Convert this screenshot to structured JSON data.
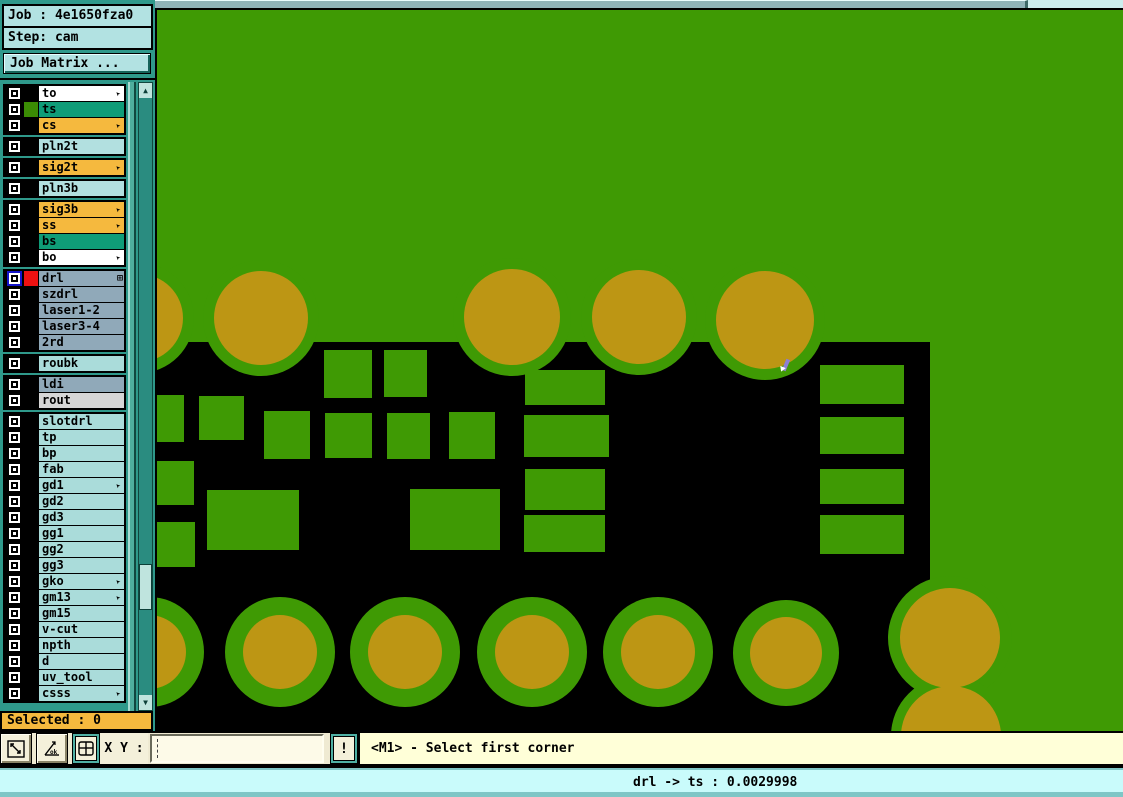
{
  "app": {
    "bg": "#2f998b"
  },
  "job_panel": {
    "job": "Job : 4e1650fza0",
    "step": "Step: cam",
    "matrix_button": "Job Matrix ..."
  },
  "icons": {
    "layer_arrow": "➤",
    "layer_grid": "⊞",
    "scroll_up": "▲",
    "scroll_down": "▼",
    "alert": "!"
  },
  "layers": {
    "groups": [
      {
        "rows": [
          {
            "label": "to",
            "bg": "#ffffff",
            "arrow": true
          },
          {
            "label": "ts",
            "bg": "#0f9c78",
            "swatch": "#3b8c04"
          },
          {
            "label": "cs",
            "bg": "#f5b93e",
            "arrow": true
          }
        ]
      },
      {
        "rows": [
          {
            "label": "pln2t",
            "bg": "#b2e0e0"
          }
        ]
      },
      {
        "rows": [
          {
            "label": "sig2t",
            "bg": "#f5b93e",
            "arrow": true
          }
        ]
      },
      {
        "rows": [
          {
            "label": "pln3b",
            "bg": "#b2e0e0"
          }
        ]
      },
      {
        "rows": [
          {
            "label": "sig3b",
            "bg": "#f5b93e",
            "arrow": true
          },
          {
            "label": "ss",
            "bg": "#f5b93e",
            "arrow": true
          },
          {
            "label": "bs",
            "bg": "#0f9c78"
          },
          {
            "label": "bo",
            "bg": "#ffffff",
            "arrow": true
          }
        ]
      },
      {
        "rows": [
          {
            "label": "drl",
            "bg": "#90a9b9",
            "swatch": "#ee1111",
            "active": true,
            "grid": true
          },
          {
            "label": "szdrl",
            "bg": "#90a9b9"
          },
          {
            "label": "laser1-2",
            "bg": "#90a9b9"
          },
          {
            "label": "laser3-4",
            "bg": "#90a9b9"
          },
          {
            "label": "2rd",
            "bg": "#90a9b9"
          }
        ]
      },
      {
        "rows": [
          {
            "label": "roubk",
            "bg": "#aadcda"
          }
        ]
      },
      {
        "rows": [
          {
            "label": "ldi",
            "bg": "#90a9b9"
          },
          {
            "label": "rout",
            "bg": "#d6d6d6"
          }
        ]
      },
      {
        "rows": [
          {
            "label": "slotdrl",
            "bg": "#aadcda"
          },
          {
            "label": "tp",
            "bg": "#aadcda"
          },
          {
            "label": "bp",
            "bg": "#aadcda"
          },
          {
            "label": "fab",
            "bg": "#aadcda"
          },
          {
            "label": "gd1",
            "bg": "#aadcda",
            "arrow": true
          },
          {
            "label": "gd2",
            "bg": "#aadcda"
          },
          {
            "label": "gd3",
            "bg": "#aadcda"
          },
          {
            "label": "gg1",
            "bg": "#aadcda"
          },
          {
            "label": "gg2",
            "bg": "#aadcda"
          },
          {
            "label": "gg3",
            "bg": "#aadcda"
          },
          {
            "label": "gko",
            "bg": "#aadcda",
            "arrow": true
          },
          {
            "label": "gm13",
            "bg": "#aadcda",
            "arrow": true
          },
          {
            "label": "gm15",
            "bg": "#aadcda"
          },
          {
            "label": "v-cut",
            "bg": "#aadcda"
          },
          {
            "label": "npth",
            "bg": "#aadcda"
          },
          {
            "label": "d",
            "bg": "#aadcda"
          },
          {
            "label": "uv_tool",
            "bg": "#aadcda"
          },
          {
            "label": "csss",
            "bg": "#aadcda",
            "arrow": true
          }
        ]
      }
    ]
  },
  "selected_bar": {
    "text": "Selected : 0"
  },
  "toolbar": {
    "xy_label": "X Y :",
    "input_value": "",
    "message": "<M1> - Select first corner"
  },
  "status_bar": {
    "text": "drl -> ts : 0.0029998"
  },
  "canvas": {
    "colors": {
      "board_green": "#3f9a04",
      "copper_pad_green": "#3f9a04",
      "drill_olive": "#bd9614",
      "clearance_black": "#000000",
      "cursor_violet": "#8d7fd4"
    },
    "black_region": [
      0,
      332,
      773,
      391
    ],
    "smd_pads": [
      [
        167,
        340,
        48,
        48
      ],
      [
        227,
        340,
        43,
        47
      ],
      [
        0,
        385,
        27,
        47
      ],
      [
        42,
        386,
        45,
        44
      ],
      [
        107,
        401,
        46,
        48
      ],
      [
        168,
        403,
        47,
        45
      ],
      [
        230,
        403,
        43,
        46
      ],
      [
        292,
        402,
        46,
        47
      ],
      [
        0,
        451,
        37,
        44
      ],
      [
        0,
        512,
        38,
        45
      ],
      [
        50,
        480,
        92,
        60
      ],
      [
        253,
        479,
        90,
        61
      ],
      [
        368,
        360,
        80,
        35
      ],
      [
        367,
        405,
        85,
        42
      ],
      [
        368,
        459,
        80,
        41
      ],
      [
        367,
        505,
        81,
        37
      ],
      [
        663,
        355,
        84,
        39
      ],
      [
        663,
        407,
        84,
        37
      ],
      [
        663,
        459,
        84,
        35
      ],
      [
        663,
        505,
        84,
        39
      ]
    ],
    "top_pads": {
      "ring_extra": 11,
      "circles": [
        [
          -18,
          308,
          44
        ],
        [
          104,
          308,
          47
        ],
        [
          355,
          307,
          48
        ],
        [
          482,
          307,
          47
        ],
        [
          608,
          310,
          49
        ]
      ]
    },
    "bottom_pads": [
      [
        -8,
        642,
        55,
        37
      ],
      [
        123,
        642,
        55,
        37
      ],
      [
        248,
        642,
        55,
        37
      ],
      [
        375,
        642,
        55,
        37
      ],
      [
        501,
        642,
        55,
        37
      ],
      [
        629,
        643,
        53,
        36
      ]
    ],
    "large_pads": [
      [
        793,
        628,
        62,
        50
      ],
      [
        794,
        726,
        60,
        50
      ]
    ],
    "cursor": [
      627,
      349
    ],
    "hscroll_thumb": [
      0,
      873
    ],
    "vscroll_thumb": [
      481,
      46
    ]
  }
}
